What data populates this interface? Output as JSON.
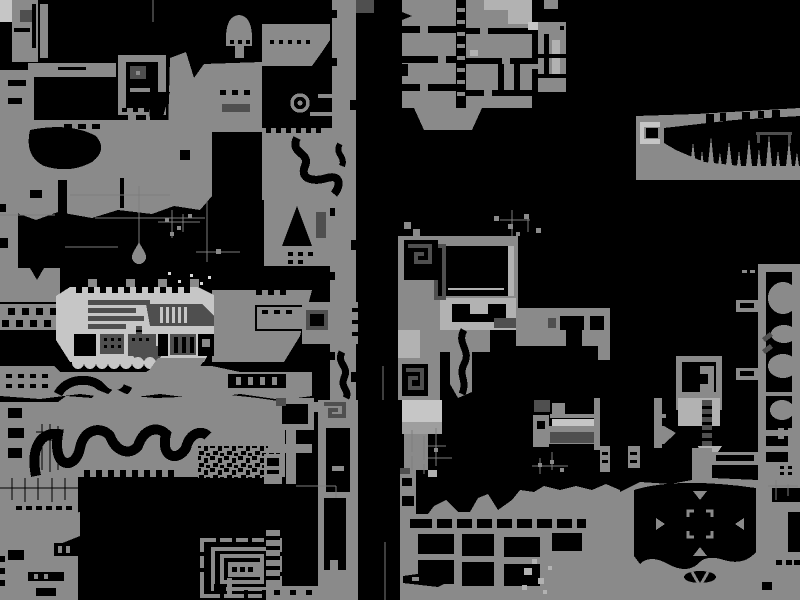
{
  "window": {
    "kind": "game-world-map-view",
    "width": 800,
    "height": 600
  },
  "palette": {
    "bg": "#000000",
    "black": "#000000",
    "terrain": "#8a8a8a",
    "mid": "#9e9e9e",
    "light": "#c6c6c6",
    "lighter": "#b2b2b2",
    "dark": "#4f4f4f",
    "highlight": "#d9d9d9",
    "wire": "#7d7d7d"
  },
  "map": {
    "style": "monochrome pixel cave map, grey terrain on black void",
    "regions": [
      {
        "id": "top-left-complex",
        "note": "rooms, bracket chamber, organic grey mass with black carvings"
      },
      {
        "id": "crater-zone",
        "note": "black chamber with ring (eye) emblem and winding snake channel"
      },
      {
        "id": "room-grid-top",
        "note": "grid of rectangular rooms joined by ladder shafts"
      },
      {
        "id": "room-grid-annex",
        "note": "small stacked room column"
      },
      {
        "id": "spike-corridor",
        "note": "horizontal cave with stalagmite spikes and docking bracket"
      },
      {
        "id": "maze-room",
        "note": "greek-key maze corners, large hollow black hall, stair blocks"
      },
      {
        "id": "ship-complex",
        "note": "light hull with dark machinery stripes, grills and scalloped fringe"
      },
      {
        "id": "wire-lines",
        "note": "thin pipe/wire lines, hanging droplet, scattered debris pixels"
      },
      {
        "id": "canyon-band",
        "note": "wide terrain band with meandering black channel and rubble patch"
      },
      {
        "id": "nested-maze",
        "note": "concentric rectangle labyrinth with tick marks"
      },
      {
        "id": "center-columns",
        "note": "vertical shafts, ladder column, black triangle peak"
      },
      {
        "id": "bottom-settlement",
        "note": "room grid carved in ground, fish-shaped cavity, pale speckles"
      },
      {
        "id": "compass-cavern",
        "note": "cavern containing reticle brackets and four triangle markers"
      },
      {
        "id": "right-tube",
        "note": "tall bordered shaft with blob pockets"
      },
      {
        "id": "conveyor-machine",
        "note": "long slatted machine arm"
      },
      {
        "id": "hatch-box",
        "note": "framed hatch with dark ladder strip"
      },
      {
        "id": "black-tower",
        "note": "black tower flanked by grey columns and legs"
      }
    ],
    "markers": [
      {
        "id": "eye-ring",
        "x": 300,
        "y": 103,
        "shape": "ring-with-dot"
      },
      {
        "id": "water-droplet",
        "x": 139,
        "y": 252,
        "shape": "teardrop"
      },
      {
        "id": "compass-marker",
        "x": 700,
        "y": 523,
        "glyphs": [
          "▼",
          "►",
          "◄",
          "▲",
          "∨"
        ],
        "shape": "corner-bracket-reticle"
      }
    ]
  }
}
